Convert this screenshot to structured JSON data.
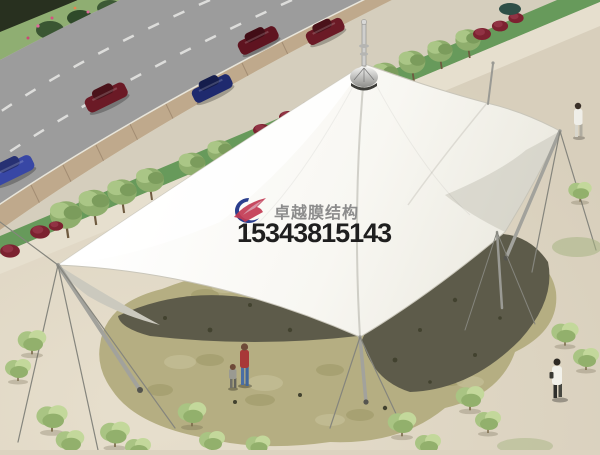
{
  "watermark": {
    "brand_name": "卓越膜结构",
    "phone": "15343815143",
    "logo_icon": "brand-logo"
  },
  "theme": {
    "plaza": "#dcd3c0",
    "hedge": "#28301f",
    "grass": "#8fae72",
    "road": "#9c9c9c",
    "sidewalk": "#bfa98c",
    "strip": "#679a5b",
    "walk": "#e6dfce",
    "stone": "#b5ae82",
    "shadowcol": "#5d5b4a",
    "canopy": "#fcfcf9",
    "logoBlue": "#2b3f8e",
    "logoRed": "#c23a52",
    "brandGray": "#8c8c8c",
    "phoneBlack": "#1f1f1f"
  }
}
